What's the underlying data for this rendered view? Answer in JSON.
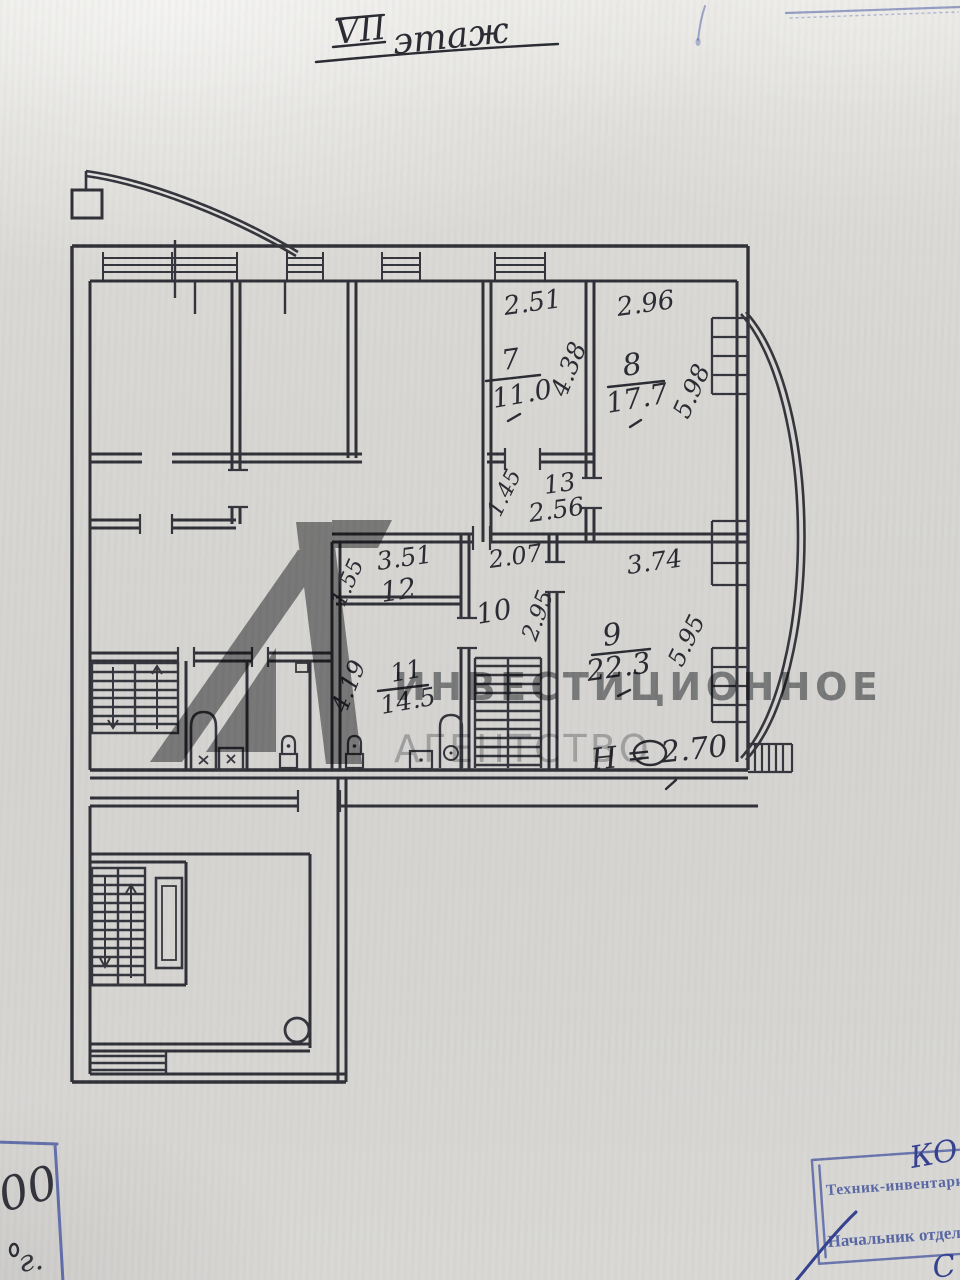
{
  "document": {
    "title": {
      "roman": "VII",
      "word": "этаж"
    }
  },
  "plan": {
    "rooms": [
      {
        "number": "7",
        "area": "11.0",
        "width": "2.51",
        "depth": "4.38"
      },
      {
        "number": "8",
        "area": "17.7",
        "width": "2.96",
        "depth": "5.98"
      },
      {
        "number": "9",
        "area": "22.3",
        "width": "3.74",
        "depth": "5.95"
      },
      {
        "number": "10",
        "width": "2.07",
        "depth": "2.95"
      },
      {
        "number": "11",
        "area": "14.5",
        "depth": "4.19"
      },
      {
        "number": "12",
        "width": "3.51",
        "depth": "1.55"
      },
      {
        "number": "13",
        "area": "2.56",
        "depth": "1.45"
      }
    ],
    "height_note": "Н = 2.70"
  },
  "watermark": {
    "line1": "ИНВЕСТИЦИОННОЕ",
    "line2": "АГЕНТСТВО",
    "logo": "41-logo"
  },
  "stamps": {
    "bottom_right": {
      "role1": "Техник-инвентаризац",
      "role2": "Начальник отдела:",
      "handwritten_initials": "КО",
      "handwritten_letter": "С"
    },
    "bottom_left": {
      "handwritten_number": "00",
      "handwritten_year_suffix": "г."
    }
  },
  "colors": {
    "ink": "#303138",
    "stamp_blue": "#4d5da2",
    "watermark_gray": "#8e8f91",
    "paper": "#d7d6d2"
  }
}
